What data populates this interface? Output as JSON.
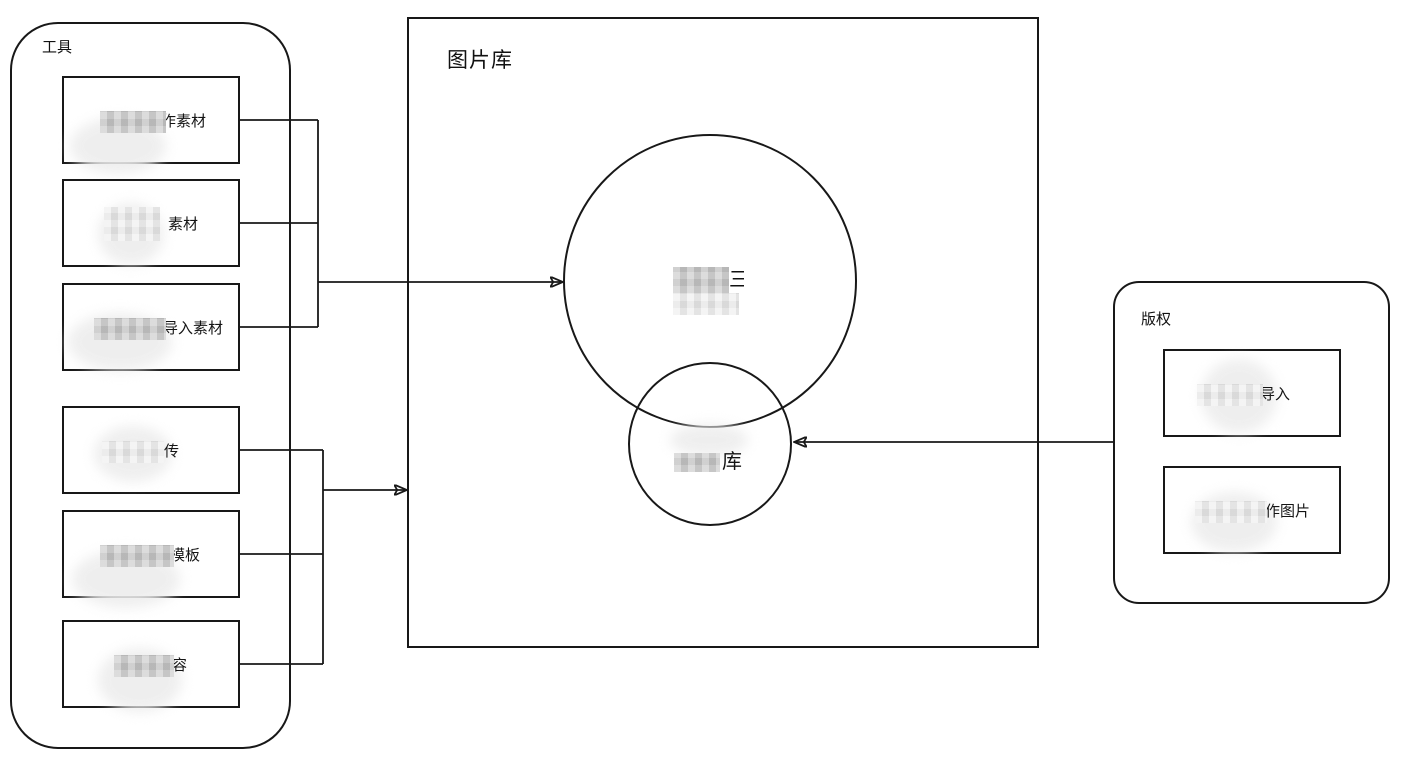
{
  "tools_panel": {
    "title": "工具",
    "items": [
      {
        "label": "作素材"
      },
      {
        "label": "素材"
      },
      {
        "label": "导入素材"
      },
      {
        "label": "传"
      },
      {
        "label": "模板"
      },
      {
        "label": "容"
      }
    ]
  },
  "library_panel": {
    "title": "图片库",
    "big_circle": {
      "fragment": "三"
    },
    "small_circle": {
      "label": "库"
    }
  },
  "copyright_panel": {
    "title": "版权",
    "items": [
      {
        "label": "导入"
      },
      {
        "label": "作图片"
      }
    ]
  },
  "colors": {
    "stroke": "#181818",
    "redaction_dark": "#c9c9c9",
    "redaction_light": "#eeeeee",
    "background": "#ffffff"
  }
}
